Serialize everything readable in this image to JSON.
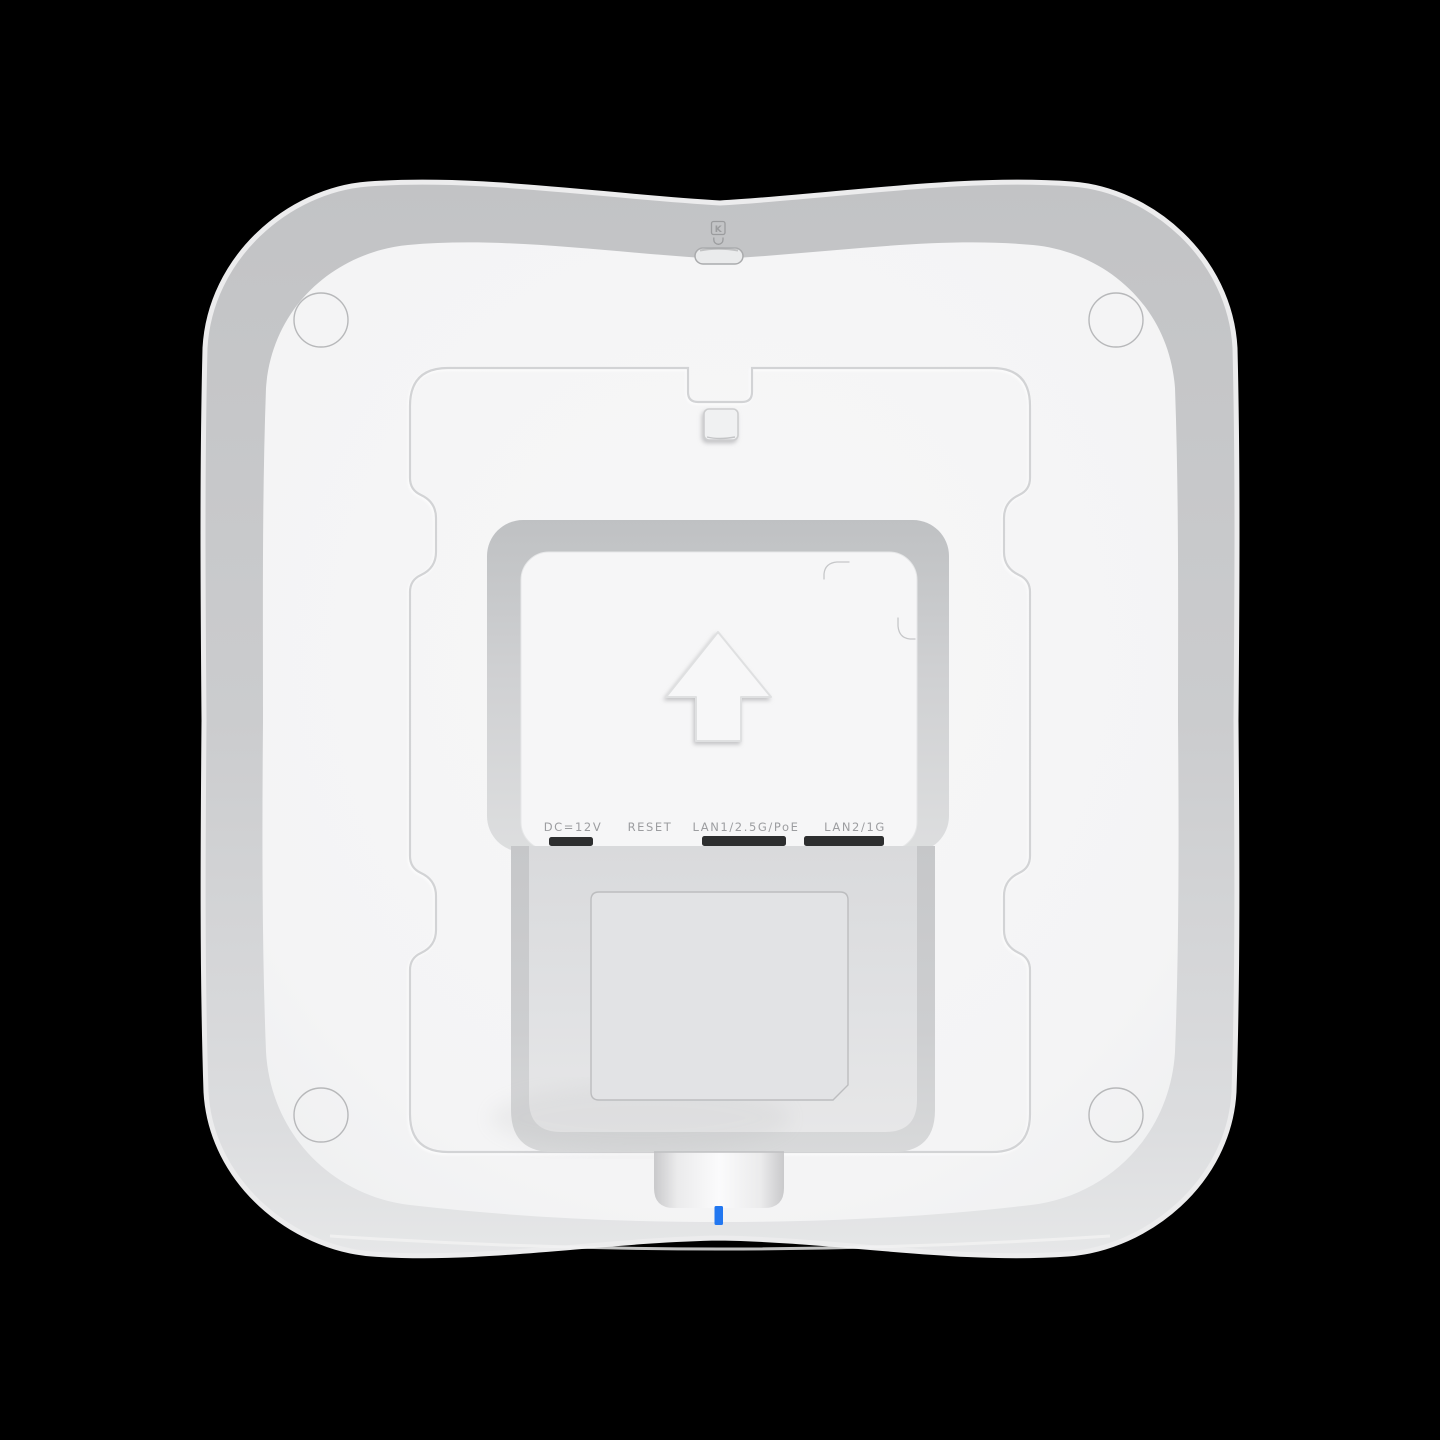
{
  "scene": {
    "description": "Rear / bottom view of a white ceiling-mount wireless access point on black background",
    "background_color": "#000000"
  },
  "device": {
    "body_color": "#f5f5f6",
    "rim_color": "#c6c7c9",
    "led_color": "#2277f0",
    "port_labels": {
      "power": "DC=12V",
      "reset": "RESET",
      "lan1": "LAN1/2.5G/PoE",
      "lan2": "LAN2/1G"
    },
    "kensington": {
      "icon_letter": "K"
    }
  }
}
